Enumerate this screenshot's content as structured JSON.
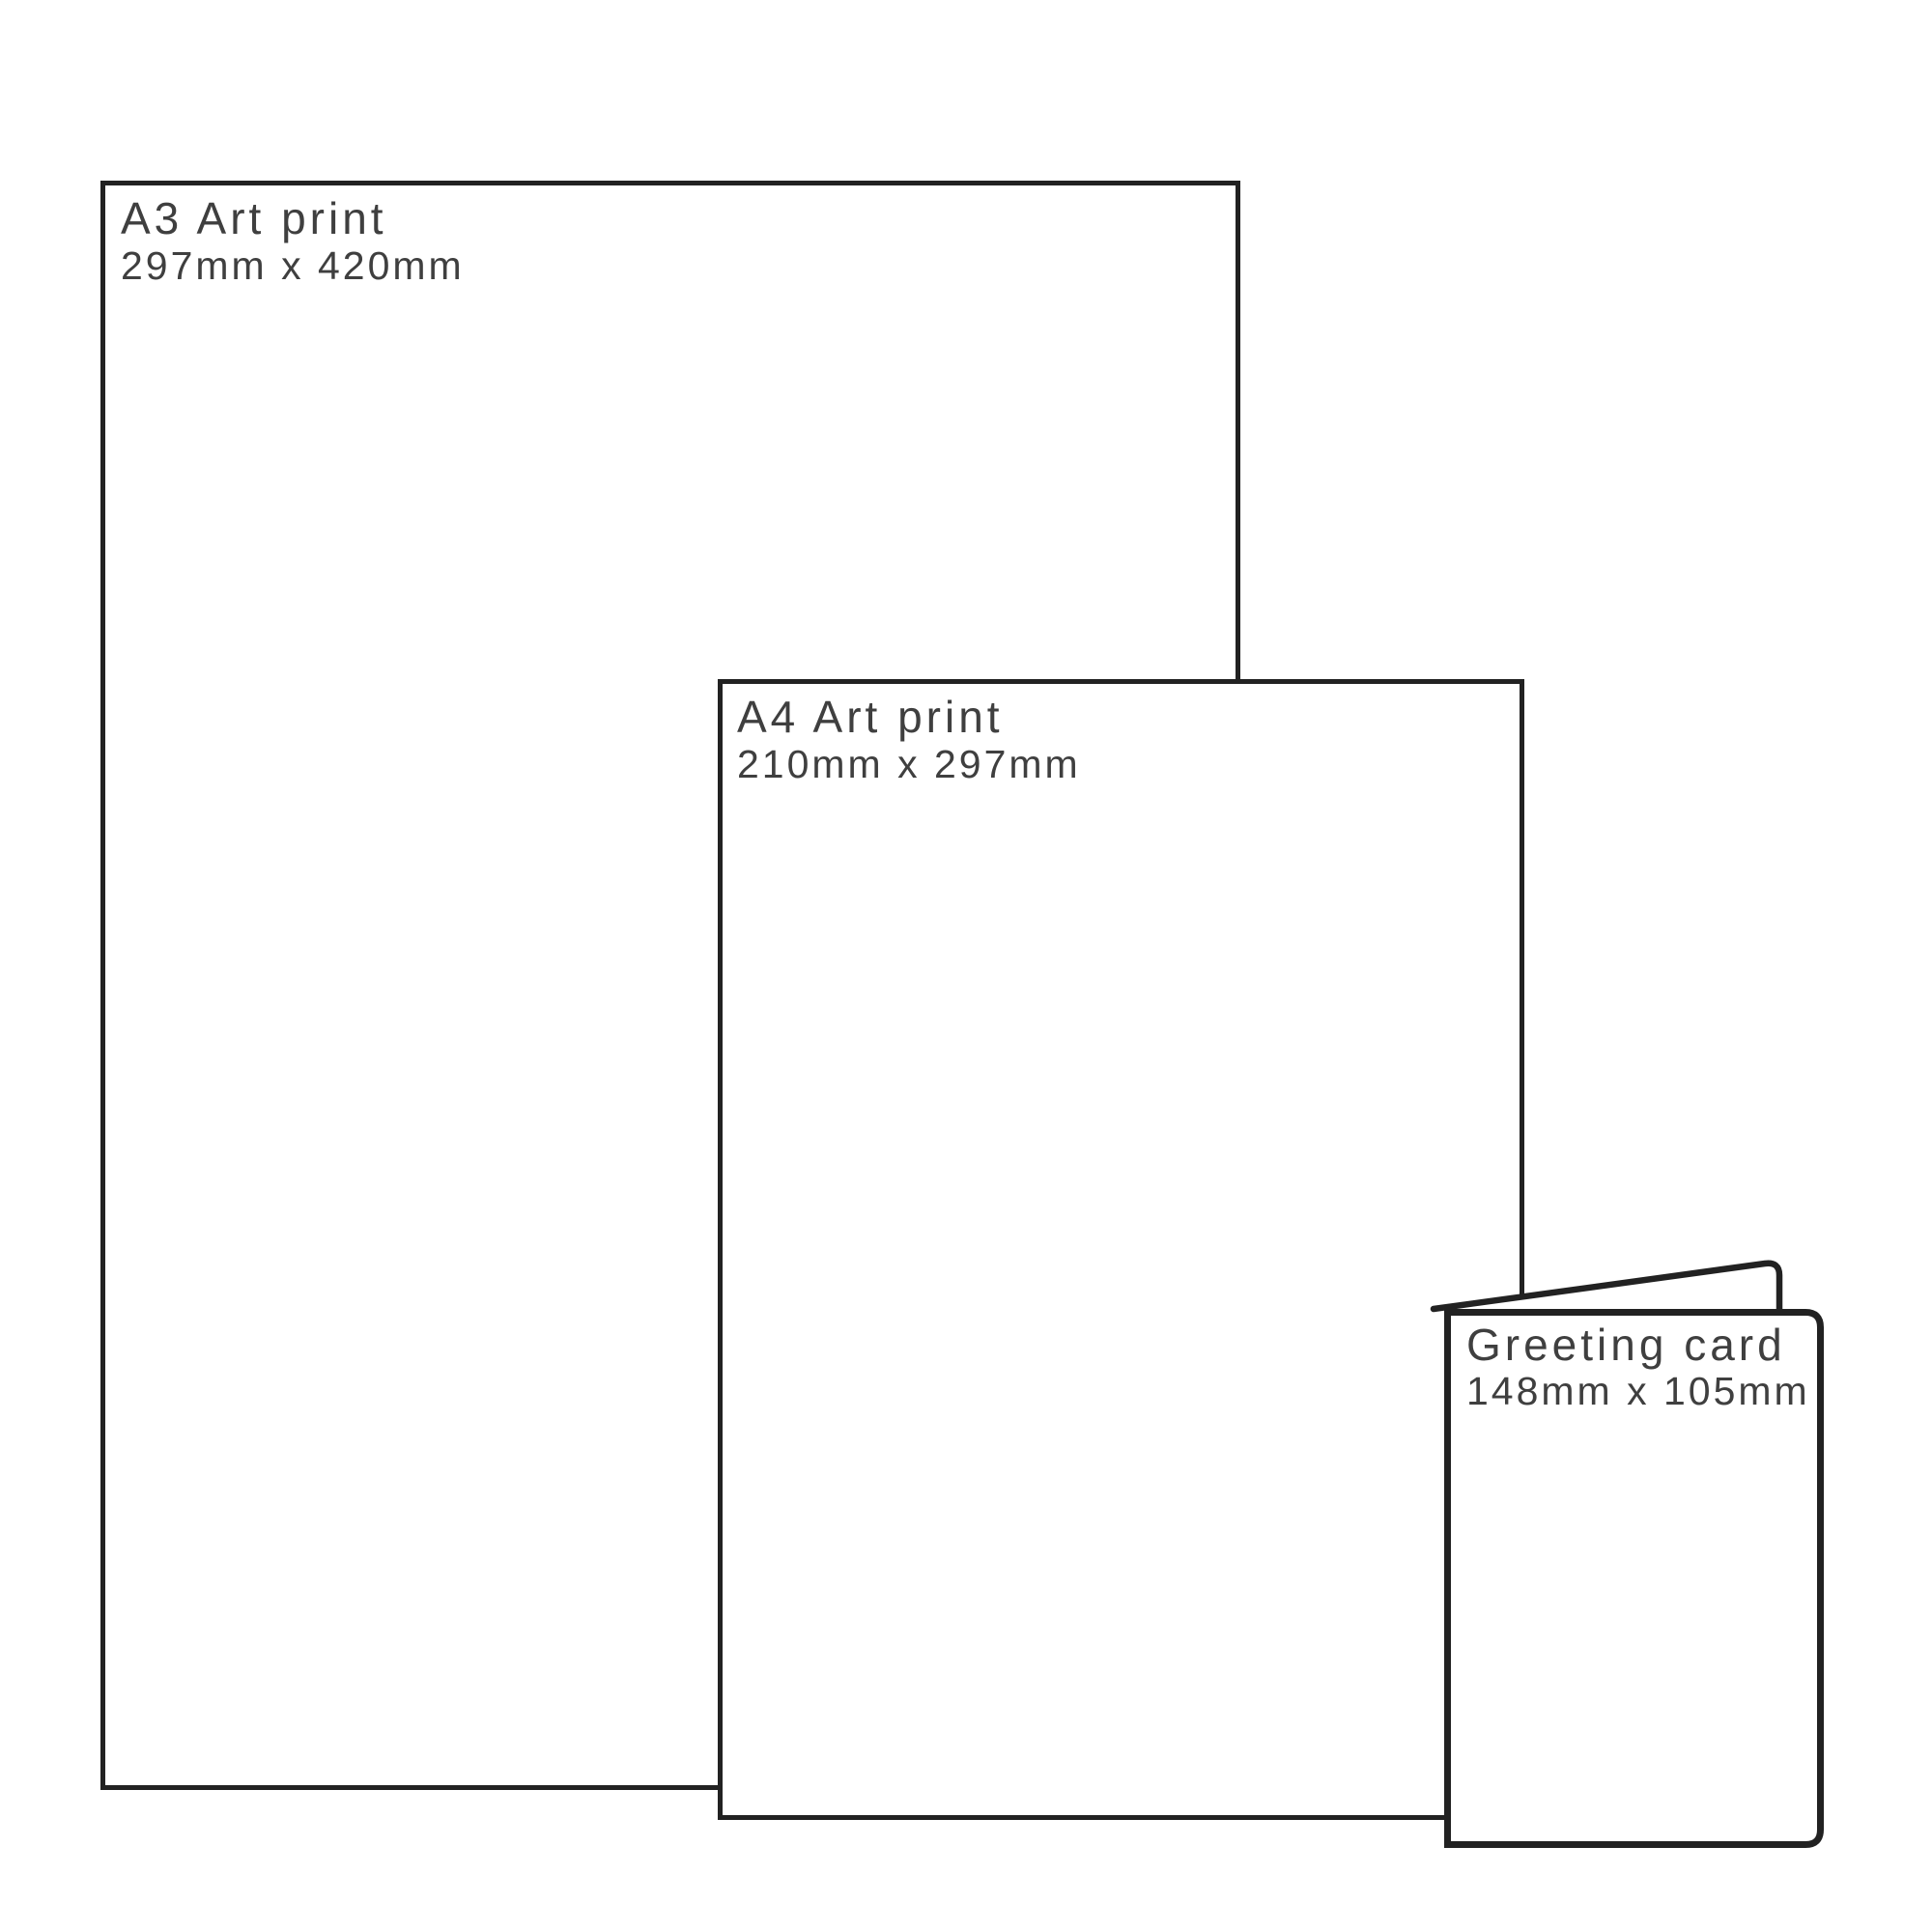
{
  "diagram_title": "Print size comparison",
  "colors": {
    "background": "#ffffff",
    "line": "#222222",
    "text": "#3f3f3f"
  },
  "items": [
    {
      "id": "a3-art-print",
      "title": "A3 Art print",
      "dimensions": "297mm x 420mm"
    },
    {
      "id": "a4-art-print",
      "title": "A4 Art print",
      "dimensions": "210mm x 297mm"
    },
    {
      "id": "greeting-card",
      "title": "Greeting card",
      "dimensions": "148mm x 105mm"
    }
  ]
}
